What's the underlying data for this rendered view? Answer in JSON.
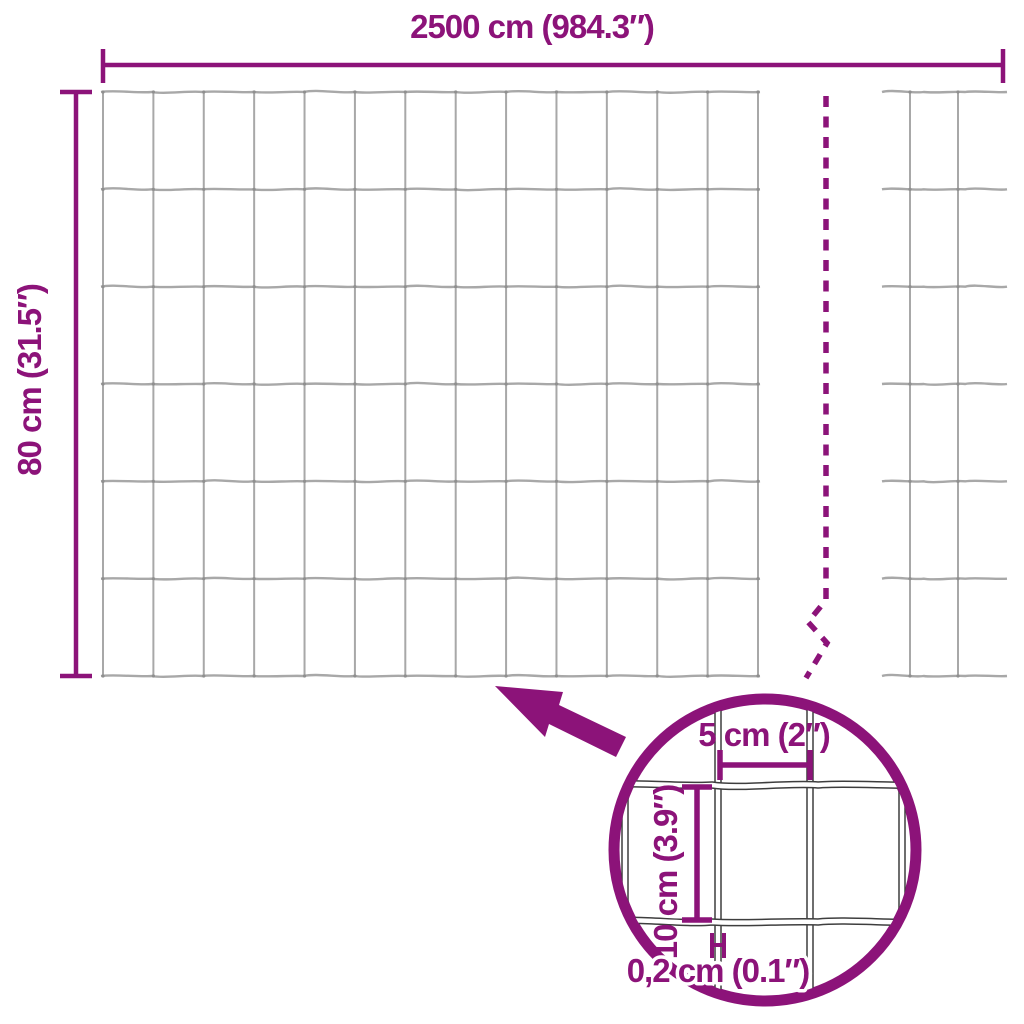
{
  "diagram": {
    "colors": {
      "background": "#FFFFFF",
      "accent": "#8C1379",
      "wire": "#A8A8A8",
      "wire_joint": "#8F8F8F",
      "detail_wire": "#3E3E3E"
    },
    "dimensions": {
      "total_width": "2500 cm (984.3″)",
      "total_height": "80 cm (31.5″)",
      "mesh_width": "5 cm (2″)",
      "mesh_height": "10 cm (3.9″)",
      "wire_thickness": "0,2 cm (0.1″)"
    }
  }
}
